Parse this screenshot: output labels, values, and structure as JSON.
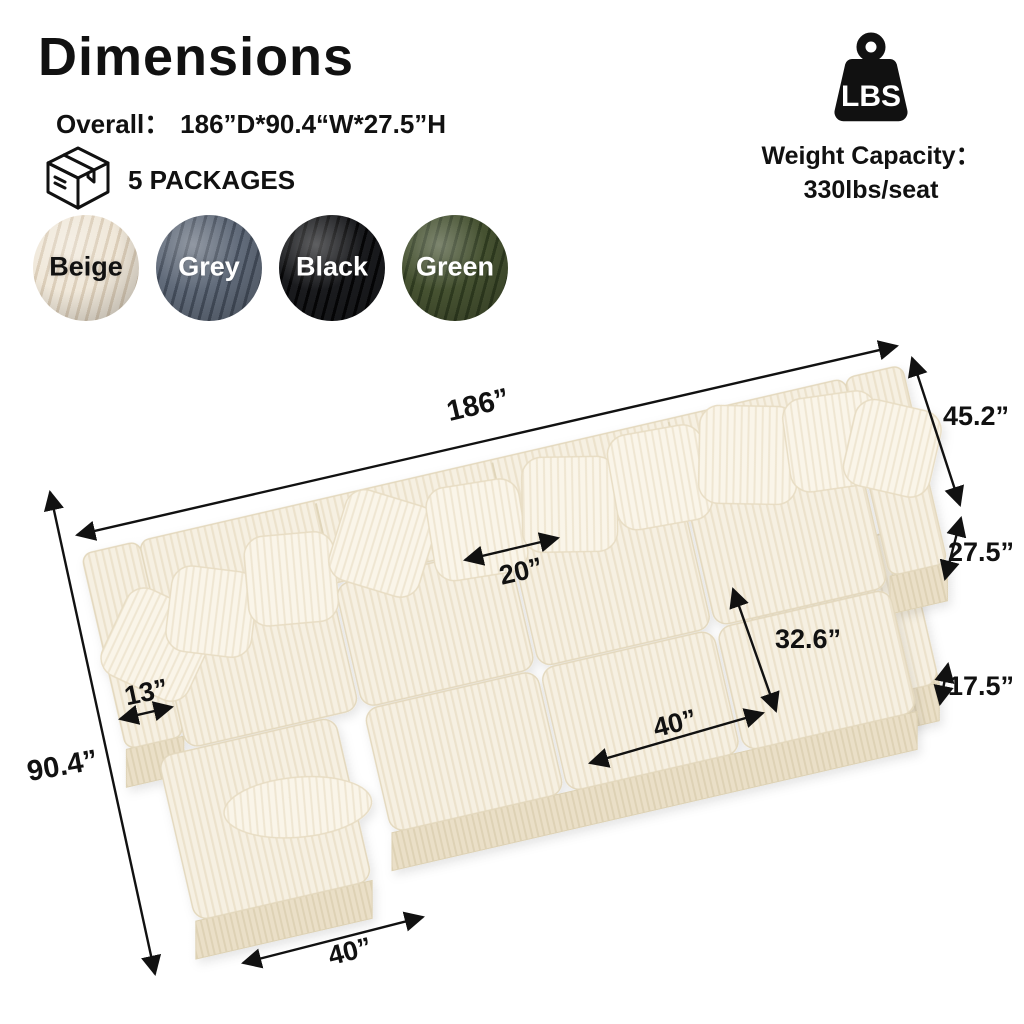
{
  "header": {
    "title": "Dimensions",
    "overall_label": "Overall：",
    "overall_value": "186”D*90.4“W*27.5”H",
    "packages_label": "5 PACKAGES"
  },
  "weight": {
    "icon_label": "LBS",
    "label": "Weight Capacity：",
    "value": "330lbs/seat"
  },
  "swatches": [
    {
      "name": "Beige",
      "base": "#f0e8da",
      "dark": "#dbcdb8",
      "text": "#111111"
    },
    {
      "name": "Grey",
      "base": "#626c7b",
      "dark": "#434c5a",
      "text": "#ffffff"
    },
    {
      "name": "Black",
      "base": "#1a1b1e",
      "dark": "#050506",
      "text": "#ffffff"
    },
    {
      "name": "Green",
      "base": "#465231",
      "dark": "#2e3a1f",
      "text": "#ffffff"
    }
  ],
  "dimensions": {
    "overall_width": "186”",
    "right_section_depth": "45.2”",
    "seat_height": "27.5”",
    "pillow_width": "20”",
    "seat_depth": "32.6”",
    "seat_width": "40”",
    "ottoman_height": "17.5”",
    "armrest_width": "13”",
    "overall_depth": "90.4”",
    "chaise_width": "40”"
  },
  "colors": {
    "background": "#ffffff",
    "annotation": "#111111",
    "sofa_base": "#f6f0e2",
    "sofa_shade": "#eadfc7",
    "pillow_base": "#faf5e9"
  }
}
